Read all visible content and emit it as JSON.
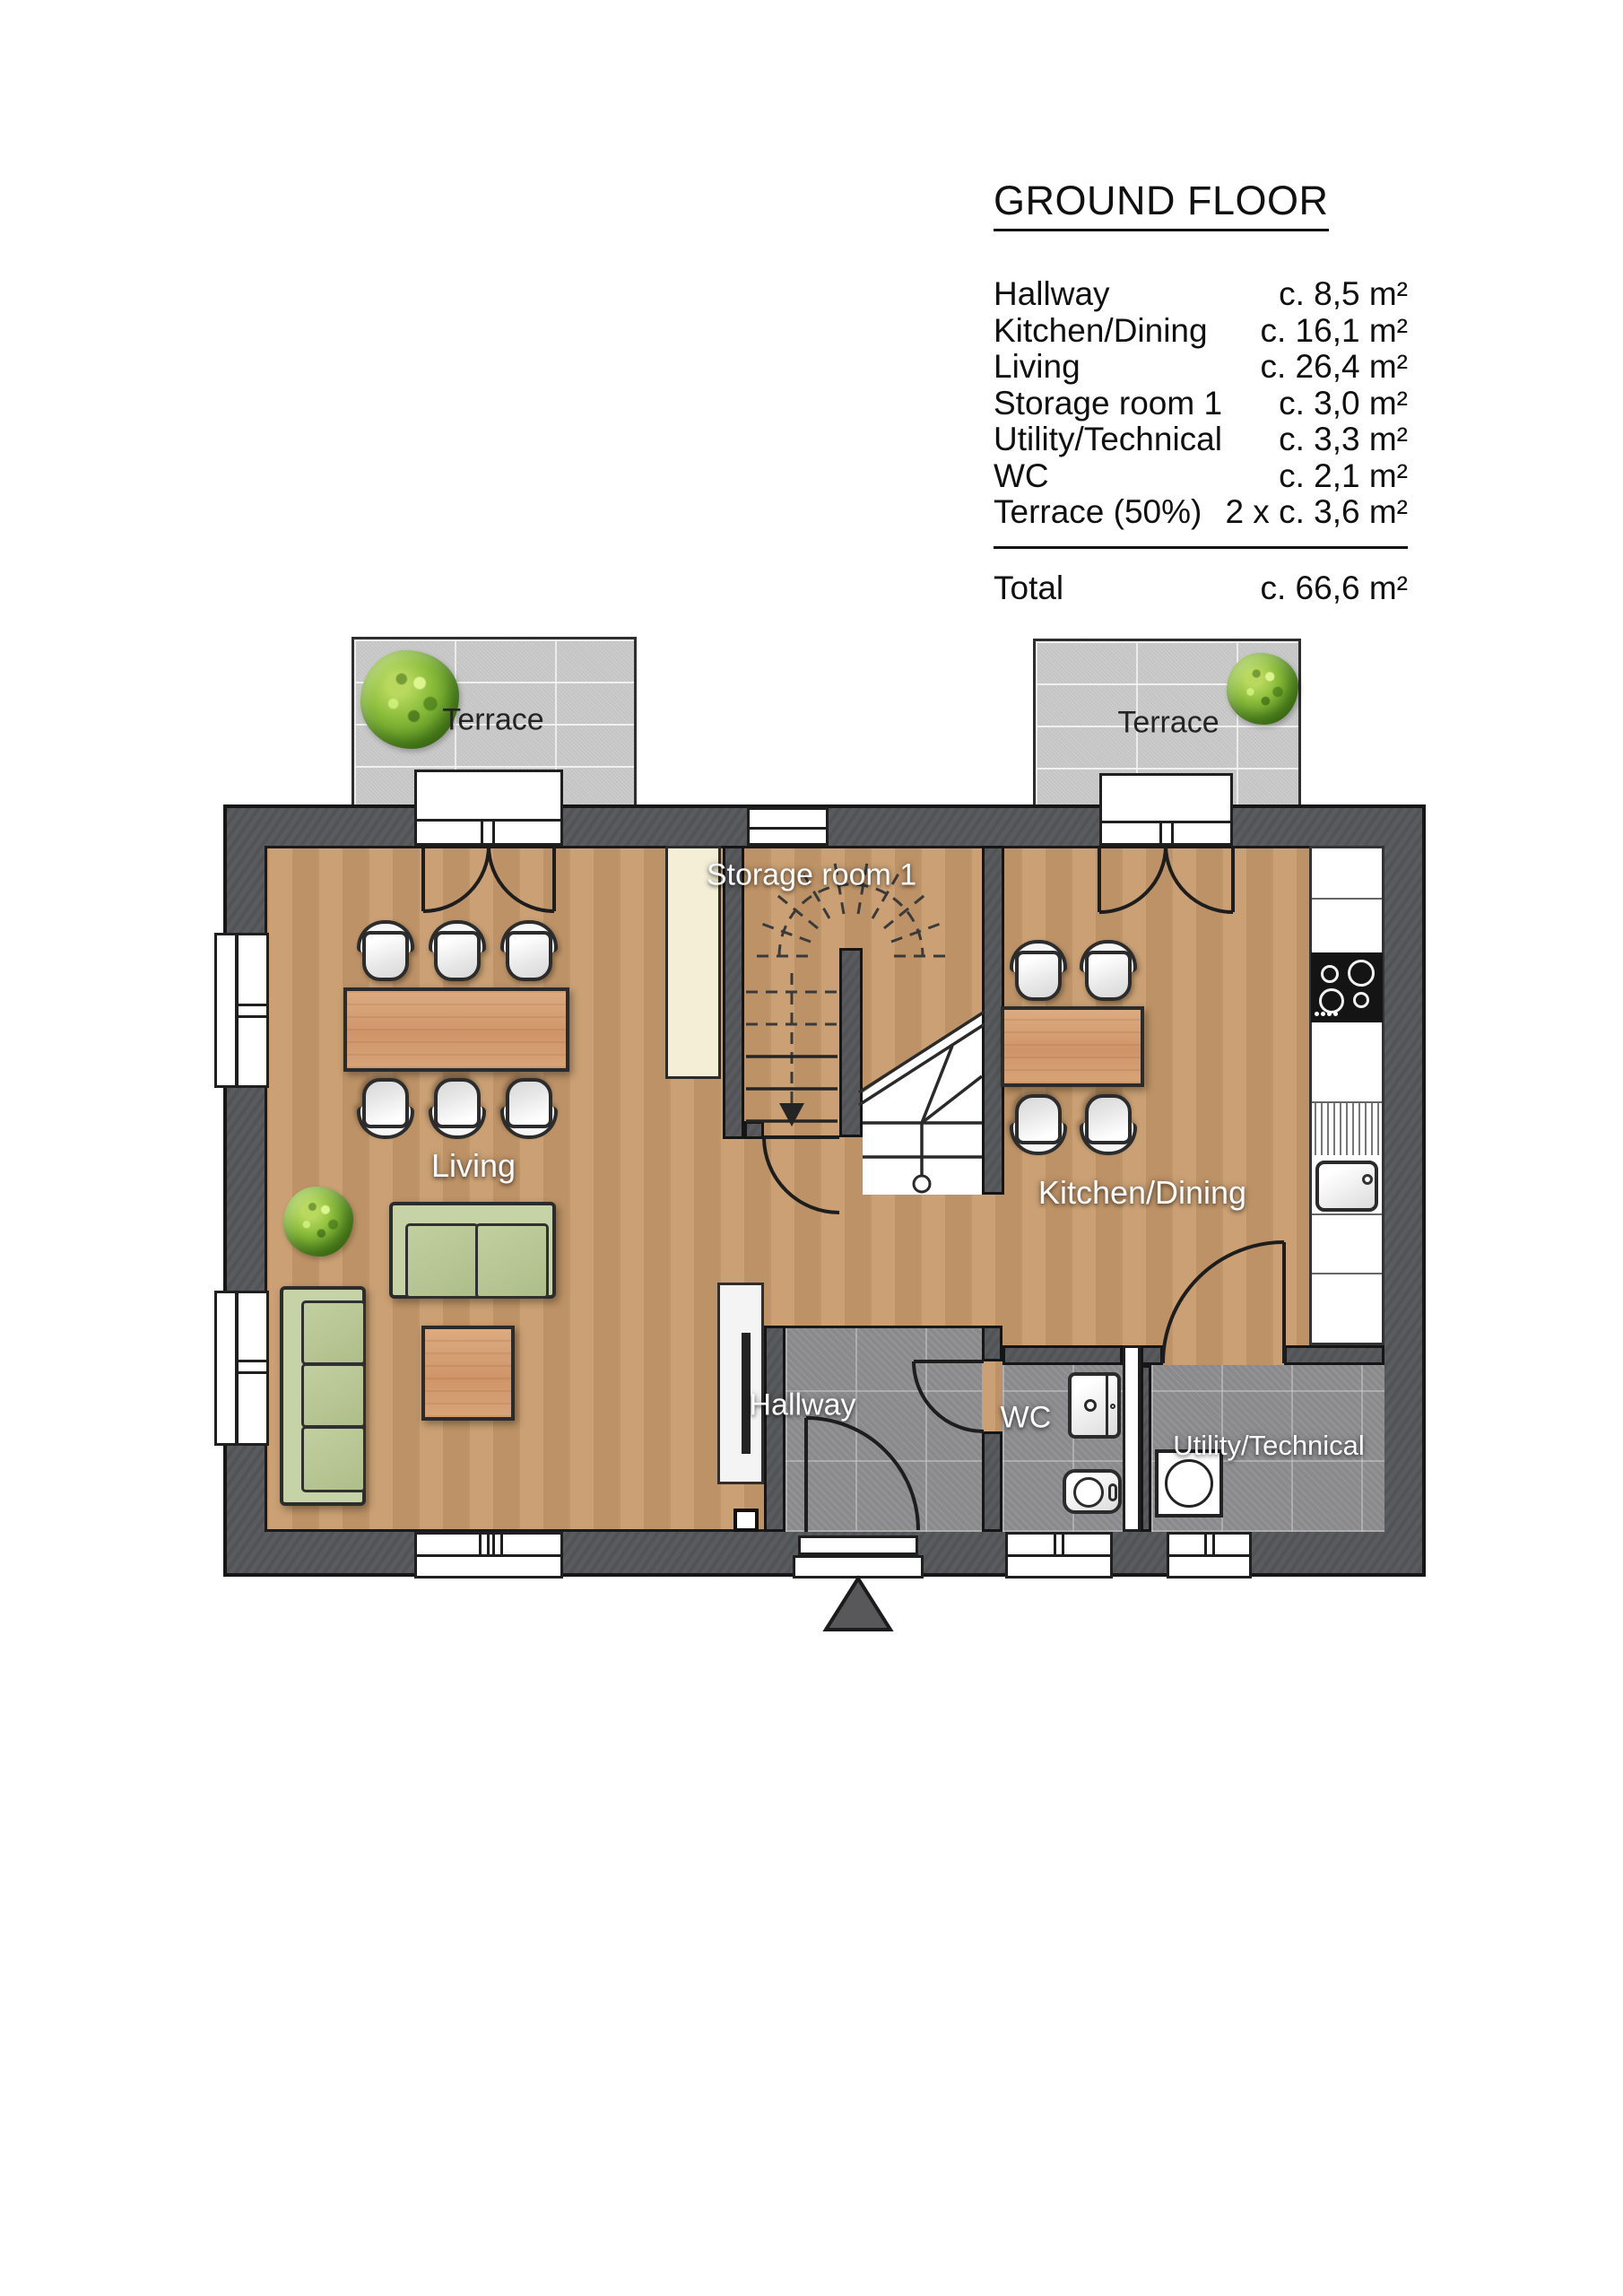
{
  "legend": {
    "title": "GROUND FLOOR",
    "rows": [
      {
        "label": "Hallway",
        "value": "c. 8,5 m²"
      },
      {
        "label": "Kitchen/Dining",
        "value": "c. 16,1 m²"
      },
      {
        "label": "Living",
        "value": "c. 26,4 m²"
      },
      {
        "label": "Storage room 1",
        "value": "c. 3,0 m²"
      },
      {
        "label": "Utility/Technical",
        "value": "c. 3,3 m²"
      },
      {
        "label": "WC",
        "value": "c. 2,1 m²"
      },
      {
        "label": "Terrace (50%)",
        "value": "2 x c. 3,6 m²"
      }
    ],
    "total": {
      "label": "Total",
      "value": "c. 66,6 m²"
    }
  },
  "plan": {
    "room_labels": {
      "terrace_left": "Terrace",
      "terrace_right": "Terrace",
      "storage": "Storage room 1",
      "living": "Living",
      "kitchen": "Kitchen/Dining",
      "hallway": "Hallway",
      "wc": "WC",
      "utility": "Utility/Technical"
    },
    "colors": {
      "wall": "#57585c",
      "wood_floor": "#c79a6b",
      "tile_floor": "#8d8d90",
      "terrace": "#cbcbcb",
      "sofa_green": "#c6d3a6",
      "furniture_wood": "#d9a67d",
      "bush_green": "#6aa52c",
      "outline": "#1d1d1d"
    }
  }
}
